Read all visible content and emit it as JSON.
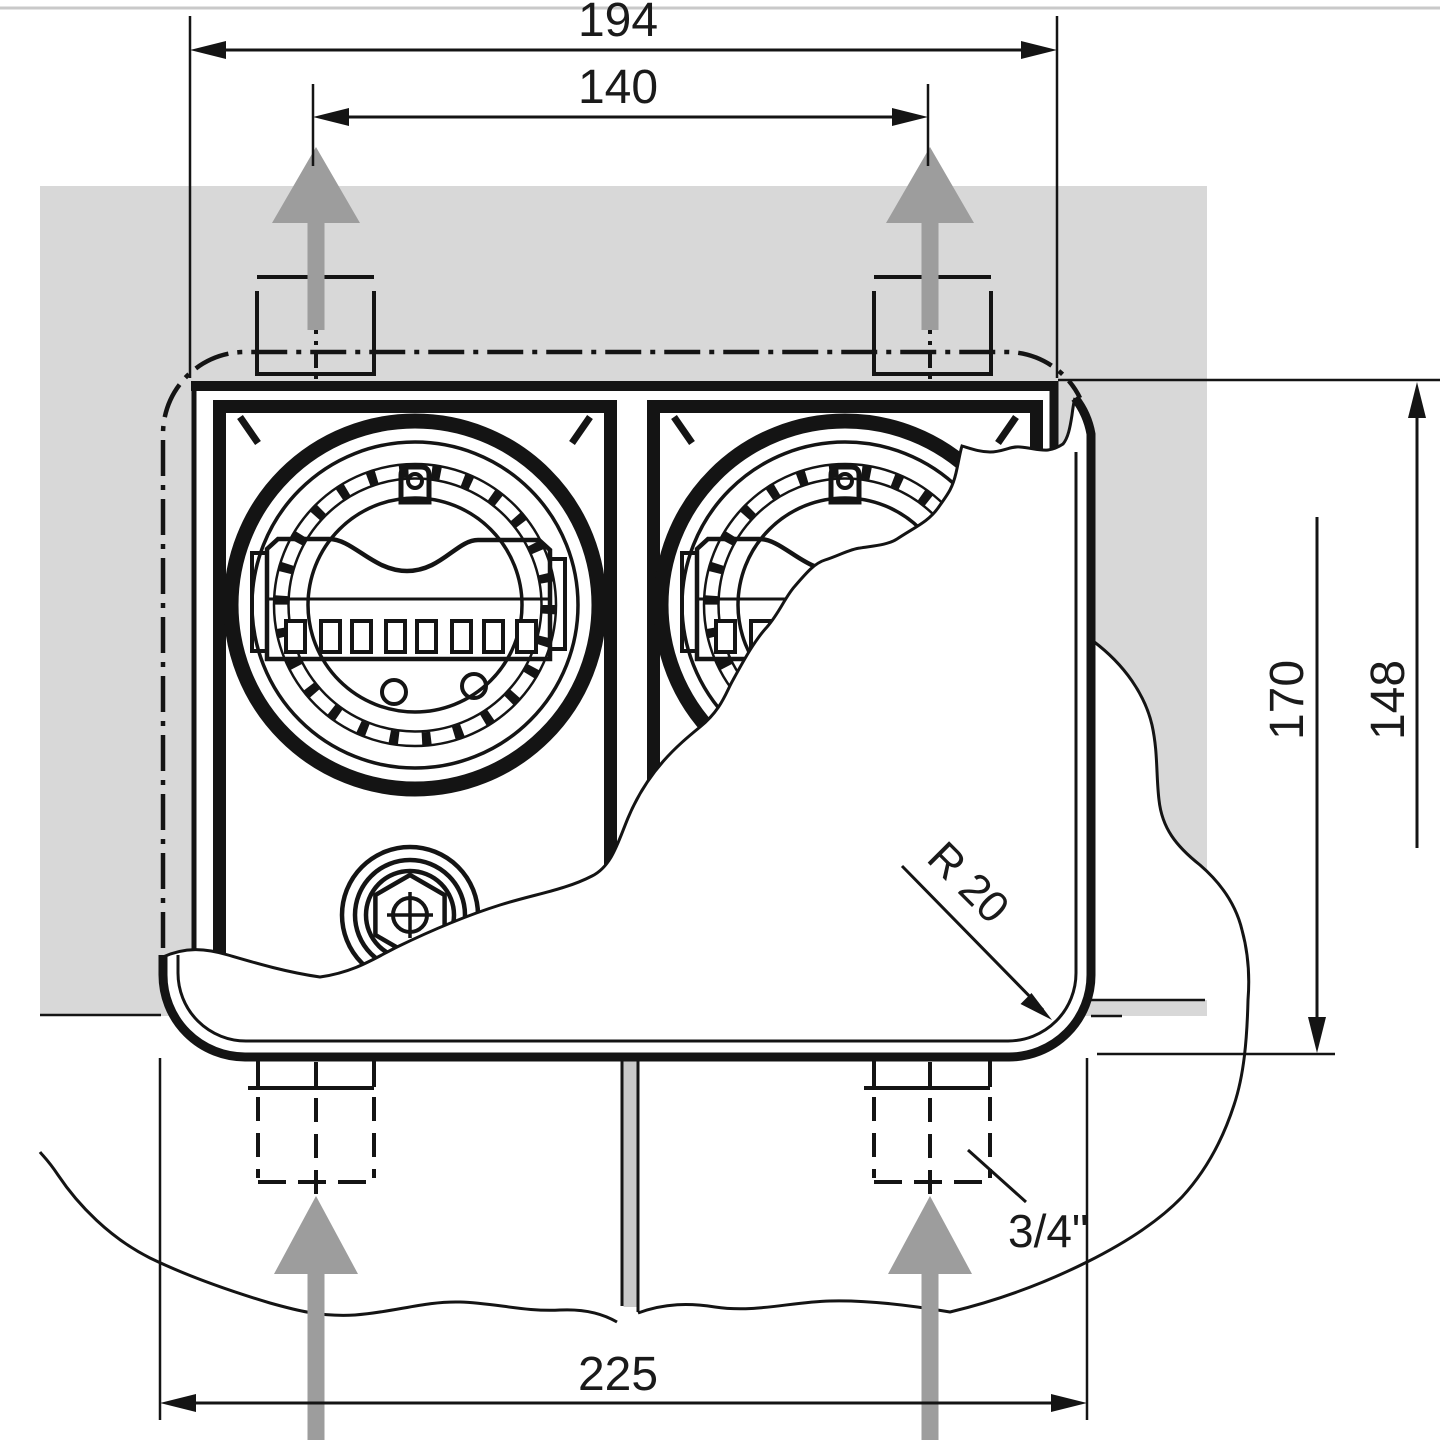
{
  "drawing": {
    "type": "technical-dimension-drawing",
    "subject": "flush-mounted twin timer enclosure, front view with cover partially broken away",
    "units": "mm",
    "labels": {
      "width_overall_top": "194",
      "width_fixing_centres": "140",
      "width_cover_bottom": "225",
      "height_cover": "170",
      "height_box": "148",
      "corner_radius": "R 20",
      "conduit_size": "3/4\""
    },
    "colors": {
      "wall_fill": "#d8d8d8",
      "joint_fill": "#c9c9c9",
      "arrow_fill": "#9d9d9d",
      "line": "#141414",
      "page_border": "#c9c9c9"
    }
  }
}
